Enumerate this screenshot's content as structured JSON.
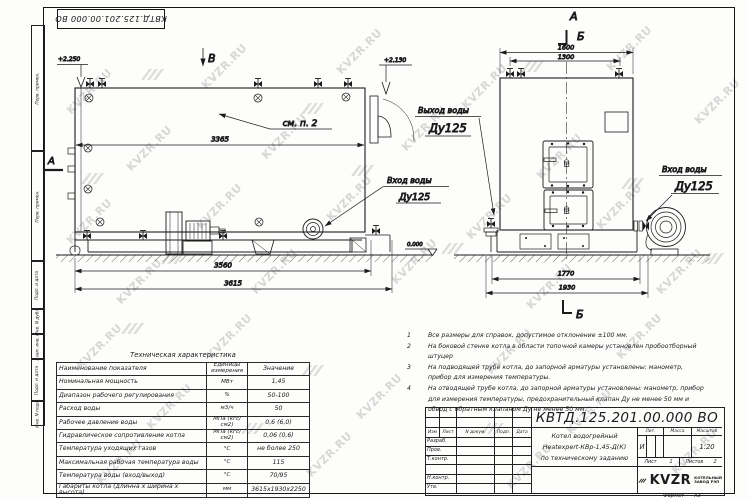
{
  "watermark": {
    "text": "KVZR.RU"
  },
  "stamp": {
    "code": "КВТД.125.201.00.000  ВО"
  },
  "margin": {
    "labels": [
      "Перв. примен.",
      "Перв. примен.",
      "Подп. и дата",
      "Инв. N дубл.",
      "Взам. инв. N",
      "Подп. и дата",
      "Инв. N подл."
    ]
  },
  "side_view": {
    "view_label": "В",
    "section_label": "А",
    "elev_left": "+2.250",
    "elev_right": "+2.130",
    "see_note": "см. п. 2",
    "dim_top": "3365",
    "dim_bottom_inner": "3560",
    "dim_bottom_outer": "3615",
    "inlet_label": "Вход воды",
    "inlet_dn": "Ду125"
  },
  "front_view": {
    "view_label": "А",
    "section_label_top": "Б",
    "section_label_bottom": "Б",
    "dim_top_outer": "1600",
    "dim_top_inner": "1300",
    "dim_bottom_inner": "1770",
    "dim_bottom_outer": "1930",
    "outlet_label": "Выход воды",
    "outlet_dn": "Ду125",
    "inlet_label": "Вход воды",
    "inlet_dn": "Ду125",
    "elev_zero": "0.000"
  },
  "notes": {
    "items": [
      {
        "n": "1",
        "text": "Все размеры для справок, допустимое отклонение ±100 мм."
      },
      {
        "n": "2",
        "text": "На боковой стенке котла в области топочной камеры установлен пробоотборный штуцер"
      },
      {
        "n": "3",
        "text": "На  подводящей трубе котла, до запорной арматуры установлены: манометр, прибор для измерения температуры."
      },
      {
        "n": "4",
        "text": "На отводящей трубе котла, до запорной арматуры установлены: манометр, прибор для измерения температуры, предохранительный клапан Ду не менее 50 мм и обвод с обратным клапаном Ду не менее 50 мм."
      }
    ]
  },
  "spec_table": {
    "title": "Техническая характеристика",
    "col_name": "Наименование показателя",
    "col_units": "Единицы измерения",
    "col_value": "Значение",
    "rows": [
      {
        "name": "Номинальная мощность",
        "units": "МВт",
        "value": "1,45"
      },
      {
        "name": "Диапазон рабочего регулирования",
        "units": "%",
        "value": "50-100"
      },
      {
        "name": "Расход воды",
        "units": "м3/ч",
        "value": "50"
      },
      {
        "name": "Рабочее давление воды",
        "units": "МПа (кгс/см2)",
        "value": "0,6 (6,0)"
      },
      {
        "name": "Гидравлическое сопротивление котла",
        "units": "МПа (кгс/см2)",
        "value": "0,06 (0,6)"
      },
      {
        "name": "Температура уходящих газов",
        "units": "°С",
        "value": "не более 250"
      },
      {
        "name": "Максимальная рабочая температура воды",
        "units": "°С",
        "value": "115"
      },
      {
        "name": "Температура воды (вход/выход)",
        "units": "°С",
        "value": "70/95"
      },
      {
        "name": "Габариты котла (длинна х ширина х высота)",
        "units": "мм",
        "value": "3615х1930х2250"
      }
    ]
  },
  "title_block": {
    "designation": "КВТД.125.201.00.000  ВО",
    "doc_cols": [
      "Изм",
      "Лист",
      "N докум.",
      "Подп.",
      "Дата"
    ],
    "roles": [
      "Разраб.",
      "Пров.",
      "Т.контр.",
      "",
      "Н.контр.",
      "Утв."
    ],
    "name_lines": [
      "Котел водогрейный",
      "Heatexpert-КВр-1,45-Д(К)",
      "по техническому заданию"
    ],
    "lit_label": "Лит.",
    "mass_label": "Масса",
    "scale_label": "Масштаб",
    "lit_value": "И",
    "scale_value": "1:20",
    "sheet_label": "Лист",
    "sheet_value": "1",
    "sheets_label": "Листов",
    "sheets_value": "2",
    "company_name": "KVZR",
    "company_sub1": "КОТЕЛЬНЫЙ",
    "company_sub2": "ЗАВОД РЭП",
    "format_label": "Формат",
    "format_value": "А3"
  }
}
